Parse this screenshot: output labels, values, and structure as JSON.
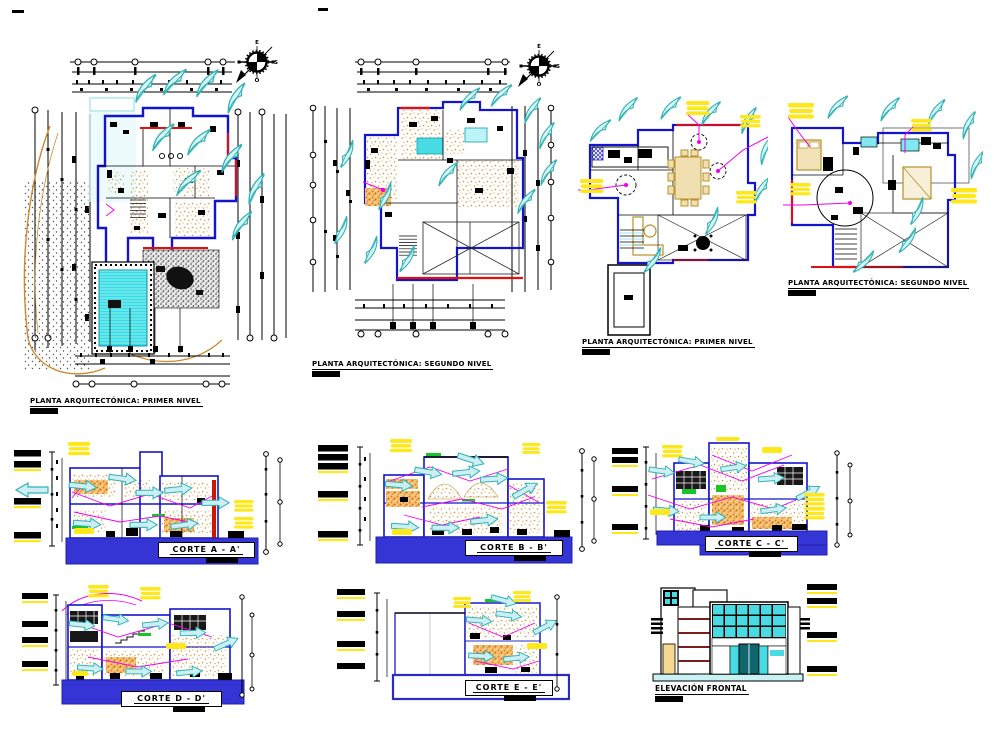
{
  "sheet": {
    "background": "#ffffff",
    "colors": {
      "wall_blue": "#1414cc",
      "plinth_blue": "#3535d6",
      "accent_red": "#e01010",
      "plant_teal": "#2fb3b6",
      "pool_cyan": "#38dce4",
      "glass_cyan": "#49dbe3",
      "highlight_yellow": "#ffe81a",
      "leader_magenta": "#f000f0",
      "grass_green": "#18c428",
      "earth_tan": "#c08a30",
      "hatch_orange": "#e07818"
    }
  },
  "compass": {
    "top": "E",
    "right": "S",
    "bottom": "O"
  },
  "plans": [
    {
      "label": "PLANTA ARQUITECTÓNICA: PRIMER NIVEL"
    },
    {
      "label": "PLANTA ARQUITECTÓNICA: SEGUNDO NIVEL"
    },
    {
      "label": "PLANTA ARQUITECTÓNICA: PRIMER NIVEL"
    },
    {
      "label": "PLANTA ARQUITECTÓNICA: SEGUNDO NIVEL"
    }
  ],
  "sections": [
    {
      "label": "CORTE  A - A'"
    },
    {
      "label": "CORTE  B - B'"
    },
    {
      "label": "CORTE  C - C'"
    },
    {
      "label": "CORTE  D - D'"
    },
    {
      "label": "CORTE  E - E'"
    }
  ],
  "elevation": {
    "label": "ELEVACIÓN FRONTAL"
  }
}
